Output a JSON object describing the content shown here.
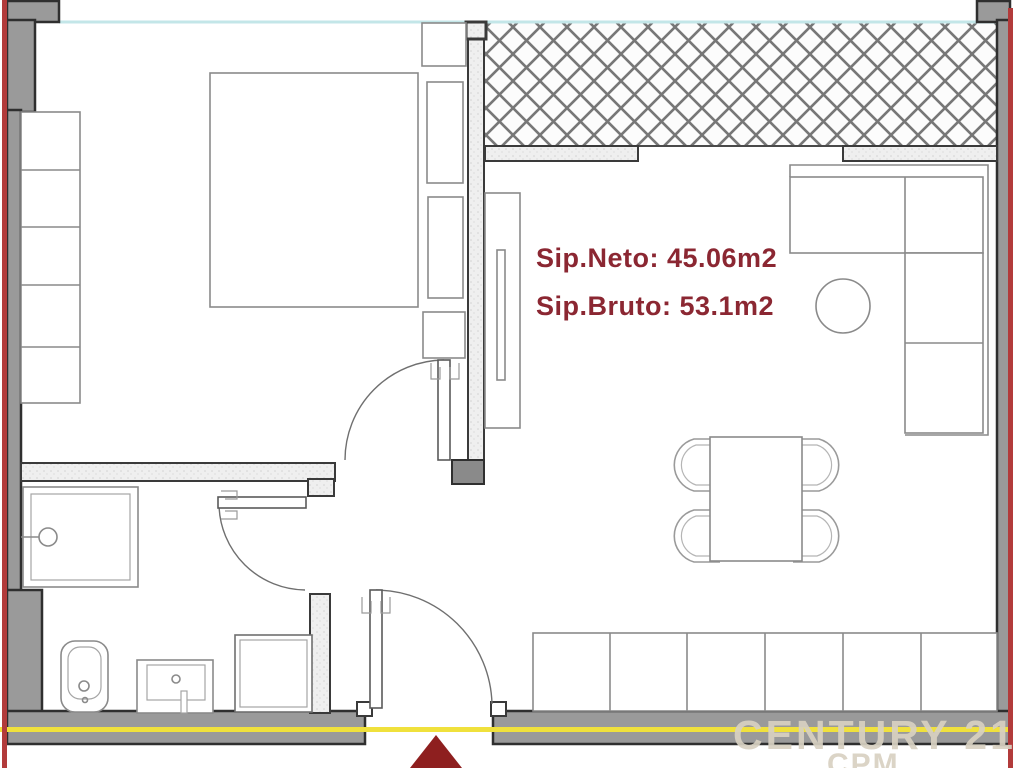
{
  "floor_plan": {
    "area_labels": {
      "neto": "Sip.Neto: 45.06m2",
      "bruto": "Sip.Bruto: 53.1m2"
    },
    "watermark": {
      "brand": "CENTURY 21",
      "sub": "CPM"
    },
    "colors": {
      "label_text_maroon": "#8b2732",
      "wall_gray": "#9a9a9a",
      "wall_outline": "#2f2f2f",
      "interior_wall_fill": "#ededed",
      "boundary_red_line": "#b23b3b",
      "section_yellow_line": "#f0e13c",
      "window_cyan_line": "#c3e6e8",
      "entrance_marker_red": "#8e1f1f",
      "watermark_beige": "#d8d1c2",
      "furniture_outline": "#8a8a8a"
    }
  }
}
